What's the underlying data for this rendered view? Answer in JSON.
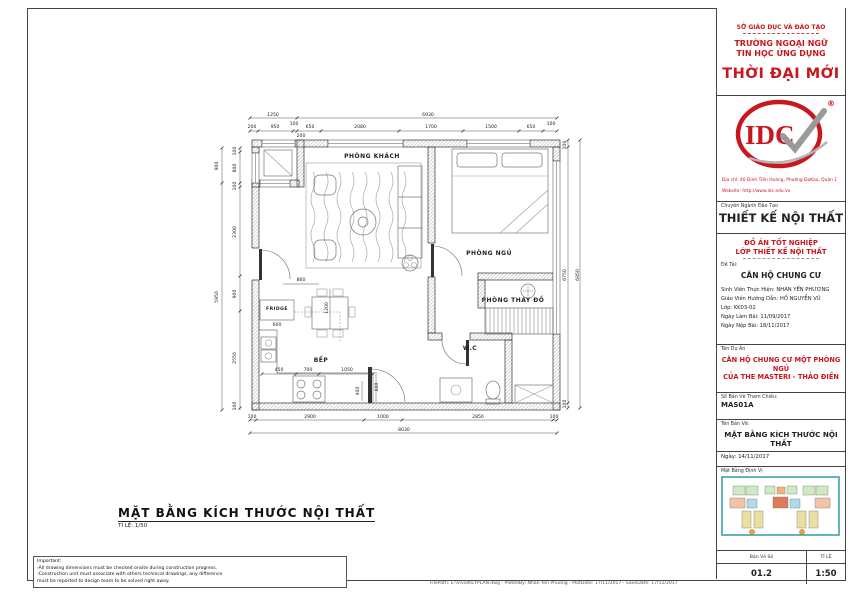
{
  "title_block": {
    "ministry": "SỞ GIÁO DỤC VÀ ĐÀO TẠO",
    "school_line1": "TRƯỜNG NGOẠI NGỮ",
    "school_line2": "TIN HỌC ỨNG DỤNG",
    "school_name": "THỜI ĐẠI MỚI",
    "logo_text": "IDC",
    "registered_mark": "®",
    "address": "Địa chỉ: 40 Đinh Tiên Hoàng, Phường ĐaKao, Quận 1",
    "website": "Website: http://www.idc.edu.vn",
    "major_label": "Chuyên Ngành Đào Tạo",
    "major": "THIẾT KẾ NỘI THẤT",
    "project_type_line1": "ĐỒ ÁN TỐT NGHIỆP",
    "project_type_line2": "LỚP THIẾT KẾ NỘI THẤT",
    "topic_label": "Đề Tài:",
    "topic": "CĂN HỘ CHUNG CƯ",
    "student": "Sinh Viên Thực Hiện: NHAN YẾN PHƯƠNG",
    "teacher": "Giáo Viên Hướng Dẫn: HỒ NGUYỄN VŨ",
    "class": "Lớp: KK03-02",
    "date_start": "Ngày Làm Bài: 11/09/2017",
    "date_submit": "Ngày Nộp Bài: 18/11/2017",
    "project_label": "Tên Dự Án",
    "project_line1": "CĂN HỘ CHUNG CƯ MỘT PHÒNG NGỦ",
    "project_line2": "CỦA THE MASTERI - THẢO ĐIỀN",
    "ref_label": "Số Bản Vẽ Tham Chiếu:",
    "ref_number": "MAS01A",
    "drawing_label": "Tên Bản Vẽ:",
    "drawing_name": "MẶT BẰNG KÍCH THƯỚC NỘI THẤT",
    "date": "Ngày: 14/11/2017",
    "keyplan_label": "Mặt Bằng Định Vị",
    "sheet_no_label": "Bản Vẽ Số",
    "sheet_no": "01.2",
    "scale_label": "TỈ LỆ",
    "scale": "1:50",
    "accent_color": "#c8171e"
  },
  "plan": {
    "title": "MẶT BẰNG KÍCH THƯỚC NỘI THẤT",
    "scale_note": "TỈ LỆ: 1/50",
    "rooms": [
      {
        "label": "PHÒNG KHÁCH",
        "x": 372,
        "y": 158
      },
      {
        "label": "PHÒNG NGỦ",
        "x": 489,
        "y": 255
      },
      {
        "label": "PHÒNG THAY ĐỒ",
        "x": 513,
        "y": 302
      },
      {
        "label": "W.C",
        "x": 470,
        "y": 350
      },
      {
        "label": "BẾP",
        "x": 321,
        "y": 362
      },
      {
        "label": "FRIDGE",
        "x": 277,
        "y": 310,
        "s": 4.6
      }
    ],
    "dims": [
      {
        "t": "1250",
        "x": 273,
        "y": 116
      },
      {
        "t": "6930",
        "x": 428,
        "y": 116
      },
      {
        "t": "200",
        "x": 252,
        "y": 128
      },
      {
        "t": "950",
        "x": 275,
        "y": 128
      },
      {
        "t": "100",
        "x": 294,
        "y": 125
      },
      {
        "t": "200",
        "x": 301,
        "y": 137
      },
      {
        "t": "650",
        "x": 310,
        "y": 128
      },
      {
        "t": "2080",
        "x": 360,
        "y": 128
      },
      {
        "t": "1700",
        "x": 431,
        "y": 128
      },
      {
        "t": "1500",
        "x": 491,
        "y": 128
      },
      {
        "t": "650",
        "x": 531,
        "y": 128
      },
      {
        "t": "100",
        "x": 551,
        "y": 125
      },
      {
        "t": "900",
        "x": 218,
        "y": 166,
        "rot": true
      },
      {
        "t": "5950",
        "x": 218,
        "y": 297,
        "rot": true
      },
      {
        "t": "100",
        "x": 236,
        "y": 151,
        "rot": true
      },
      {
        "t": "800",
        "x": 236,
        "y": 168,
        "rot": true
      },
      {
        "t": "100",
        "x": 236,
        "y": 186,
        "rot": true
      },
      {
        "t": "2300",
        "x": 236,
        "y": 232,
        "rot": true
      },
      {
        "t": "900",
        "x": 236,
        "y": 294,
        "rot": true
      },
      {
        "t": "2550",
        "x": 236,
        "y": 358,
        "rot": true
      },
      {
        "t": "100",
        "x": 236,
        "y": 406,
        "rot": true
      },
      {
        "t": "100",
        "x": 566,
        "y": 145,
        "rot": true
      },
      {
        "t": "6750",
        "x": 566,
        "y": 275,
        "rot": true
      },
      {
        "t": "100",
        "x": 566,
        "y": 404,
        "rot": true
      },
      {
        "t": "6950",
        "x": 579,
        "y": 275,
        "rot": true
      },
      {
        "t": "100",
        "x": 252,
        "y": 418
      },
      {
        "t": "2900",
        "x": 310,
        "y": 418
      },
      {
        "t": "1000",
        "x": 383,
        "y": 418
      },
      {
        "t": "2850",
        "x": 478,
        "y": 418
      },
      {
        "t": "100",
        "x": 554,
        "y": 418
      },
      {
        "t": "8030",
        "x": 404,
        "y": 431
      },
      {
        "t": "860",
        "x": 301,
        "y": 281
      },
      {
        "t": "1200",
        "x": 328,
        "y": 308,
        "rot": true
      },
      {
        "t": "600",
        "x": 277,
        "y": 326
      },
      {
        "t": "450",
        "x": 279,
        "y": 371
      },
      {
        "t": "700",
        "x": 308,
        "y": 371
      },
      {
        "t": "1050",
        "x": 347,
        "y": 371
      },
      {
        "t": "400",
        "x": 359,
        "y": 391,
        "rot": true
      },
      {
        "t": "600",
        "x": 378,
        "y": 387,
        "rot": true
      }
    ]
  },
  "footer": {
    "notes": [
      "Important:",
      "-All drawing dimensions must be checked onsite during construction progress.",
      "-Construction unit must associate with others technical drawings, any difference",
      "must be reported to design team to be solved right away."
    ],
    "plot_info": "FilePath: E:\\Viva\\KEYPLAN.dwg - PlotedBy: Nhan Yen Phuong - PlotDate: 17/11/2017 - SaveDate: 17/11/2017"
  }
}
